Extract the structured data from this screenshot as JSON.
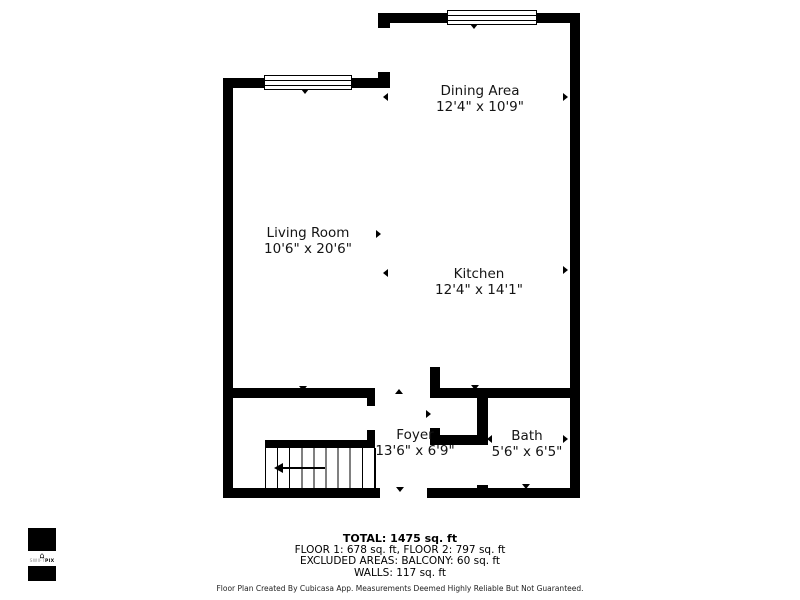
{
  "colors": {
    "wall": "#000000",
    "background": "#ffffff",
    "text": "#141414"
  },
  "rooms": [
    {
      "name": "Dining Area",
      "dims": "12'4\" x 10'9\""
    },
    {
      "name": "Living Room",
      "dims": "10'6\" x 20'6\""
    },
    {
      "name": "Kitchen",
      "dims": "12'4\" x 14'1\""
    },
    {
      "name": "Foyer",
      "dims": "13'6\" x 6'9\""
    },
    {
      "name": "Bath",
      "dims": "5'6\" x 6'5\""
    }
  ],
  "summary": {
    "total": "TOTAL: 1475 sq. ft",
    "floors": "FLOOR 1: 678 sq. ft, FLOOR 2: 797 sq. ft",
    "excluded": "EXCLUDED AREAS: BALCONY: 60 sq. ft",
    "walls": "WALLS: 117 sq. ft",
    "disclaimer": "Floor Plan Created By Cubicasa App. Measurements Deemed Highly Reliable But Not Guaranteed."
  },
  "logo": {
    "brand_left": "SWIFT",
    "brand_right": "PIX"
  }
}
